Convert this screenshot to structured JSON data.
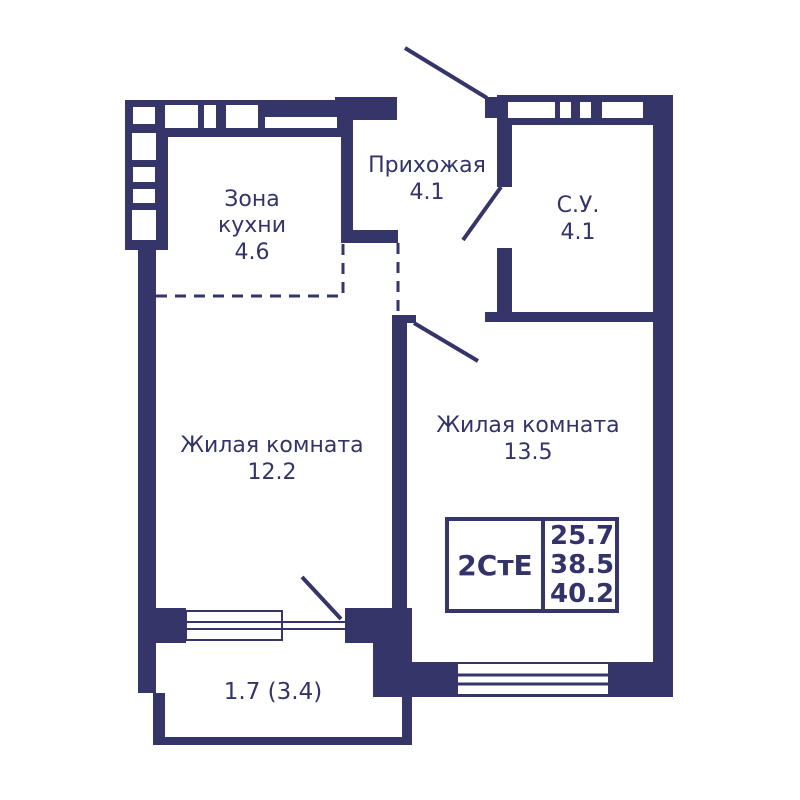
{
  "colors": {
    "wall": "#353569",
    "text": "#33336a",
    "background": "#ffffff"
  },
  "stamp": {
    "type": "2СтЕ",
    "values": [
      "25.7",
      "38.5",
      "40.2"
    ]
  },
  "rooms": {
    "kitchen": {
      "name": "Зона кухни",
      "area": "4.6"
    },
    "hallway": {
      "name": "Прихожая",
      "area": "4.1"
    },
    "bathroom": {
      "name": "С.У.",
      "area": "4.1"
    },
    "living_left": {
      "name": "Жилая комната",
      "area": "12.2"
    },
    "living_right": {
      "name": "Жилая комната",
      "area": "13.5"
    },
    "balcony": {
      "area": "1.7 (3.4)"
    }
  }
}
